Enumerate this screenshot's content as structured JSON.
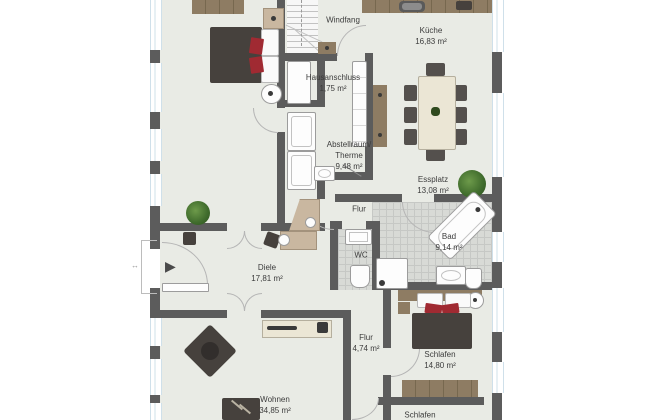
{
  "plan": {
    "type": "floor-plan",
    "rooms": [
      {
        "id": "windfang",
        "label": "Windfang"
      },
      {
        "id": "kueche",
        "label": "Küche\n16,83 m²"
      },
      {
        "id": "hausanschluss",
        "label": "Hausanschluss\n1,75 m²"
      },
      {
        "id": "abstellraum",
        "label": "Abstellraum/\nTherme\n9,48 m²"
      },
      {
        "id": "essplatz",
        "label": "Essplatz\n13,08 m²"
      },
      {
        "id": "flur-upper",
        "label": "Flur"
      },
      {
        "id": "wc",
        "label": "WC"
      },
      {
        "id": "bad",
        "label": "Bad\n9,14 m²"
      },
      {
        "id": "diele",
        "label": "Diele\n17,81 m²"
      },
      {
        "id": "wohnen",
        "label": "Wohnen\n34,85 m²"
      },
      {
        "id": "flur-lower",
        "label": "Flur\n4,74 m²"
      },
      {
        "id": "schlafen",
        "label": "Schlafen\n14,80 m²"
      },
      {
        "id": "schlafen2",
        "label": "Schlafen"
      }
    ],
    "icons": {
      "entrance-arrow": "▶",
      "dimension-span": "↔"
    },
    "colors": {
      "wall": "#5c5c5c",
      "floor": "#e9ebe5",
      "tile": "#d8dad6",
      "tileline": "#c6c8c5",
      "glass": "#cfe0ea",
      "wood": "#8e7c63",
      "wooddark": "#77684f",
      "cream": "#ebe6d5",
      "darkf": "#46413d",
      "accent": "#a02a32",
      "chair": "#54504d",
      "fixb": "#9c9c9c",
      "labelc": "#3c3c3c",
      "arcc": "#b5b5b5"
    }
  }
}
